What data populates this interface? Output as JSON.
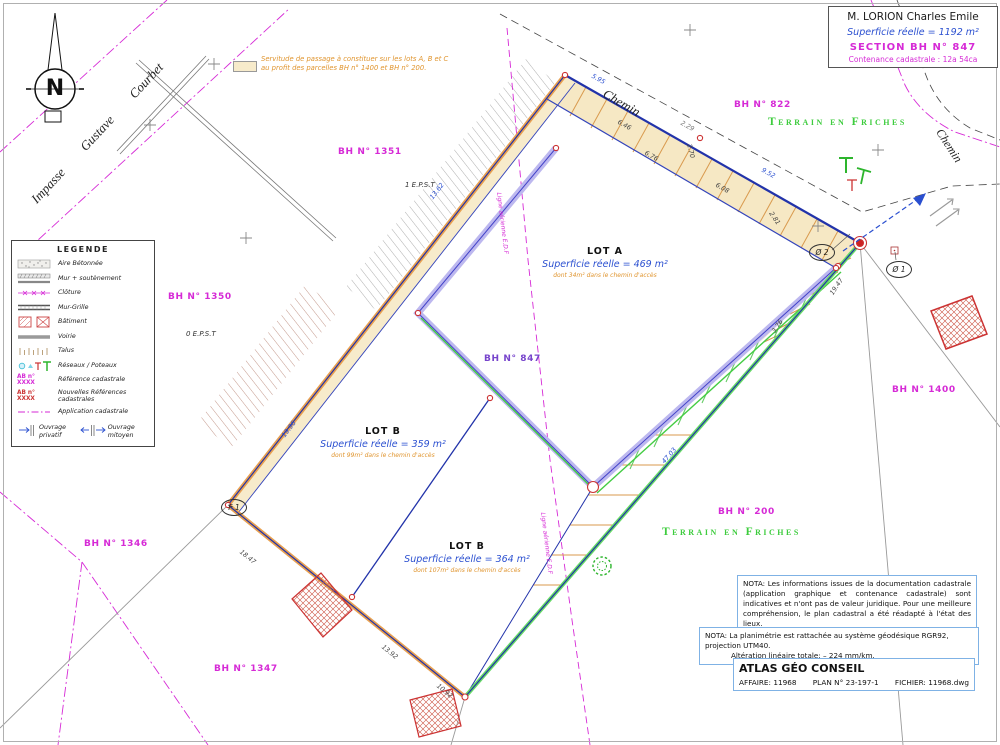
{
  "north": {
    "label": "N"
  },
  "title_block": {
    "owner": "M. LORION Charles Emile",
    "superficie": "Superficie réelle = 1192 m²",
    "section": "SECTION BH N° 847",
    "contenance": "Contenance cadastrale : 12a 54ca"
  },
  "servitude_note": {
    "line1": "Servitude de passage à constituer sur les lots A, B et C",
    "line2": "au profit des parcelles BH n° 1400 et BH n° 200."
  },
  "legend": {
    "title": "LEGENDE",
    "ref_label": "AB n° XXXX",
    "items": [
      {
        "label": "Aire Bétonnée"
      },
      {
        "label": "Mur + soutènement"
      },
      {
        "label": "Clôture"
      },
      {
        "label": "Mur-Grille"
      },
      {
        "label": "Bâtiment"
      },
      {
        "label": "Voirie"
      },
      {
        "label": "Talus"
      },
      {
        "label": "Réseaux / Poteaux"
      },
      {
        "label": "Référence cadastrale"
      },
      {
        "label": "Nouvelles Références cadastrales"
      },
      {
        "label": "Application cadastrale"
      }
    ],
    "private_label": "Ouvrage privatif",
    "shared_label": "Ouvrage mitoyen"
  },
  "streets": {
    "impasse": "Impasse Gustave Courbet",
    "chemin_top": "Chemin",
    "chemin_right": "Chemin"
  },
  "parcels": [
    {
      "label": "BH N° 822"
    },
    {
      "label": "BH N° 1351"
    },
    {
      "label": "BH N° 1350"
    },
    {
      "label": "BH N° 847"
    },
    {
      "label": "BH N° 1400"
    },
    {
      "label": "BH N° 200"
    },
    {
      "label": "BH N° 1346"
    },
    {
      "label": "BH N° 1347"
    }
  ],
  "terrain_label": "Terrain en Friches",
  "lots": [
    {
      "name": "LOT A",
      "area": "Superficie réelle = 469 m²",
      "access": "dont 34m² dans le chemin d'accès"
    },
    {
      "name": "LOT B",
      "area": "Superficie réelle = 359 m²",
      "access": "dont 99m² dans le chemin d'accès"
    },
    {
      "name": "LOT B",
      "area": "Superficie réelle = 364 m²",
      "access": "dont 107m² dans le chemin d'accès"
    }
  ],
  "eps": {
    "one": "1 E.P.S.T",
    "zero": "0 E.P.S.T"
  },
  "edf_label": "Ligne aérienne E.D.F",
  "points": {
    "f1": "F 1",
    "o2": "Ø 2",
    "o1": "Ø 1"
  },
  "dims": [
    "5.95",
    "6.46",
    "6.76",
    "2.70",
    "6.08",
    "9.52",
    "2.81",
    "2.29",
    "19.47",
    "3.76",
    "47.03",
    "13.62",
    "18.47",
    "13.92",
    "10.92",
    "19.96"
  ],
  "notes": {
    "nota1": "NOTA: Les informations issues de la documentation cadastrale (application graphique et contenance cadastrale) sont indicatives et n'ont pas de valeur juridique. Pour une meilleure compréhension, le plan cadastral a été réadapté à l'état des lieux.",
    "nota2_line1": "NOTA: La planimétrie est rattachée au système géodésique RGR92, projection UTM40.",
    "nota2_line2": "Altération linéaire totale: – 224 mm/km."
  },
  "footer": {
    "company": "ATLAS GÉO CONSEIL",
    "affaire": "AFFAIRE: 11968",
    "plan": "PLAN N° 23-197-1",
    "fichier": "FICHIER: 11968.dwg"
  },
  "colors": {
    "magenta": "#d62ad6",
    "blue_text": "#2a4fd0",
    "orange_text": "#e0952f",
    "green": "#3ecc3e",
    "violet_band": "#bdb8ef",
    "tan": "#f7ebcb",
    "boundary_blue": "#2233aa",
    "marker_red": "#cc3333",
    "box_border": "#7fb2e5"
  }
}
